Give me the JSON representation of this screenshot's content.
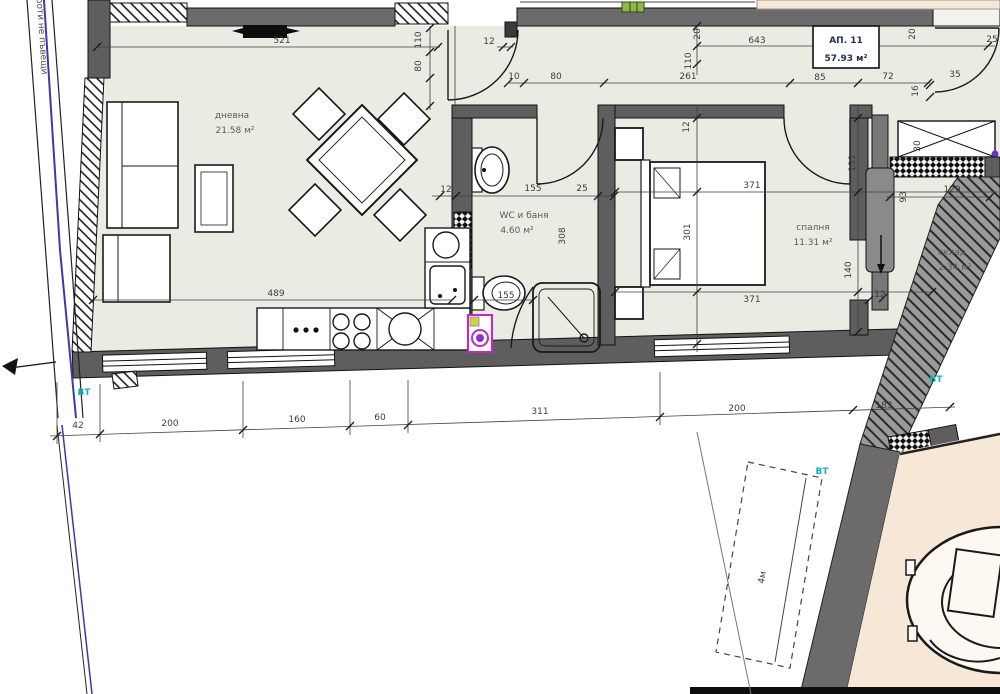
{
  "plan": {
    "apartment": {
      "label": "АП. 11",
      "area": "57.93 м²"
    },
    "rooms": [
      {
        "name": "дневна",
        "area": "21.58 м²"
      },
      {
        "name": "WC и баня",
        "area": "4.60 м²"
      },
      {
        "name": "спалня",
        "area": "11.31 м²"
      },
      {
        "name": "склад",
        "area": "2.34 м²"
      }
    ],
    "boundary_note": "до коелботи не пъвещи",
    "vt_marker": "ВТ",
    "offset_label": "4м",
    "dimension_chains": {
      "top_living": [
        "521"
      ],
      "entry": [
        "110",
        "80",
        "12",
        "10",
        "80",
        "261"
      ],
      "corridor": [
        "643",
        "20",
        "110",
        "85",
        "72",
        "16",
        "20",
        "25",
        "35"
      ],
      "bathroom": [
        "12",
        "155",
        "25",
        "308",
        "155"
      ],
      "bedroom": [
        "371",
        "301",
        "371",
        "12",
        "131",
        "140"
      ],
      "storage": [
        "129",
        "93",
        "30",
        "12"
      ],
      "kitchen": [
        "489"
      ],
      "bottom": [
        "42",
        "200",
        "160",
        "60",
        "311",
        "200",
        "183"
      ]
    },
    "colors": {
      "wall": "#5e5e5e",
      "corridor_band": "#6b6b6b",
      "interior": "#eaece4",
      "neighbor_fill": "#f6e7d7",
      "accent_teal": "#17b1b1",
      "boundary_blue": "#3a3aa8",
      "washer_magenta": "#cc22cc",
      "dot_purple": "#6633cc",
      "marker_green": "#8db84a"
    }
  },
  "texts": [
    {
      "n": "dim-521",
      "t": "521",
      "x": 282,
      "y": 43
    },
    {
      "n": "dim-110-entry",
      "t": "110",
      "x": 421,
      "y": 40,
      "r": -90,
      "s": 8
    },
    {
      "n": "dim-80-entry",
      "t": "80",
      "x": 421,
      "y": 66,
      "r": -90,
      "s": 8
    },
    {
      "n": "dim-12-entry",
      "t": "12",
      "x": 489,
      "y": 44,
      "s": 8
    },
    {
      "n": "dim-10",
      "t": "10",
      "x": 514,
      "y": 79,
      "s": 8
    },
    {
      "n": "dim-80",
      "t": "80",
      "x": 556,
      "y": 79
    },
    {
      "n": "dim-261",
      "t": "261",
      "x": 688,
      "y": 79
    },
    {
      "n": "dim-85",
      "t": "85",
      "x": 820,
      "y": 80,
      "s": 8
    },
    {
      "n": "dim-72",
      "t": "72",
      "x": 888,
      "y": 79,
      "s": 8
    },
    {
      "n": "dim-643",
      "t": "643",
      "x": 757,
      "y": 43
    },
    {
      "n": "dim-20-a",
      "t": "20",
      "x": 700,
      "y": 34,
      "r": -90,
      "s": 8
    },
    {
      "n": "dim-110-b",
      "t": "110",
      "x": 691,
      "y": 61,
      "r": -90,
      "s": 8
    },
    {
      "n": "dim-20-b",
      "t": "20",
      "x": 915,
      "y": 34,
      "r": -90,
      "s": 8
    },
    {
      "n": "dim-25",
      "t": "25",
      "x": 992,
      "y": 42,
      "s": 8
    },
    {
      "n": "dim-35",
      "t": "35",
      "x": 955,
      "y": 77,
      "s": 8
    },
    {
      "n": "dim-16",
      "t": "16",
      "x": 918,
      "y": 91,
      "r": -90,
      "s": 8
    },
    {
      "n": "dim-30",
      "t": "30",
      "x": 920,
      "y": 146,
      "r": -90,
      "s": 8
    },
    {
      "n": "dim-129",
      "t": "129",
      "x": 952,
      "y": 192,
      "s": 8
    },
    {
      "n": "dim-93",
      "t": "93",
      "x": 906,
      "y": 197,
      "r": -90,
      "s": 8
    },
    {
      "n": "room-storage-name",
      "t": "склад",
      "x": 952,
      "y": 255,
      "c": "room"
    },
    {
      "n": "room-storage-area",
      "t": "2.34 м²",
      "x": 955,
      "y": 270,
      "c": "room"
    },
    {
      "n": "dim-12-storage",
      "t": "12",
      "x": 880,
      "y": 297,
      "s": 8
    },
    {
      "n": "room-bedroom-name",
      "t": "спалня",
      "x": 813,
      "y": 230,
      "c": "room"
    },
    {
      "n": "room-bedroom-area",
      "t": "11.31 м²",
      "x": 813,
      "y": 245,
      "c": "room"
    },
    {
      "n": "dim-371-top",
      "t": "371",
      "x": 752,
      "y": 188
    },
    {
      "n": "dim-371-bottom",
      "t": "371",
      "x": 752,
      "y": 302
    },
    {
      "n": "dim-301",
      "t": "301",
      "x": 690,
      "y": 232,
      "r": -90
    },
    {
      "n": "dim-12-bedroom",
      "t": "12",
      "x": 689,
      "y": 127,
      "r": -90,
      "s": 8
    },
    {
      "n": "dim-131",
      "t": "131",
      "x": 855,
      "y": 163,
      "r": -90,
      "s": 8
    },
    {
      "n": "dim-140",
      "t": "140",
      "x": 851,
      "y": 270,
      "r": -90,
      "s": 8
    },
    {
      "n": "room-bath-name",
      "t": "WC и баня",
      "x": 524,
      "y": 218,
      "c": "room"
    },
    {
      "n": "room-bath-area",
      "t": "4.60 м²",
      "x": 517,
      "y": 233,
      "c": "room"
    },
    {
      "n": "dim-12-bath",
      "t": "12",
      "x": 446,
      "y": 192,
      "s": 8
    },
    {
      "n": "dim-155-top",
      "t": "155",
      "x": 533,
      "y": 191
    },
    {
      "n": "dim-25-bath",
      "t": "25",
      "x": 582,
      "y": 191,
      "s": 8
    },
    {
      "n": "dim-308",
      "t": "308",
      "x": 565,
      "y": 236,
      "r": -90,
      "s": 8
    },
    {
      "n": "dim-155-bottom",
      "t": "155",
      "x": 506,
      "y": 298,
      "s": 8
    },
    {
      "n": "room-living-name",
      "t": "дневна",
      "x": 232,
      "y": 118,
      "c": "room"
    },
    {
      "n": "room-living-area",
      "t": "21.58 м²",
      "x": 235,
      "y": 133,
      "c": "room"
    },
    {
      "n": "dim-489",
      "t": "489",
      "x": 276,
      "y": 296,
      "s": 8
    },
    {
      "n": "dim-42",
      "t": "42",
      "x": 78,
      "y": 428,
      "s": 8
    },
    {
      "n": "dim-200-a",
      "t": "200",
      "x": 170,
      "y": 426
    },
    {
      "n": "dim-160",
      "t": "160",
      "x": 297,
      "y": 422
    },
    {
      "n": "dim-60",
      "t": "60",
      "x": 380,
      "y": 420,
      "s": 8
    },
    {
      "n": "dim-311",
      "t": "311",
      "x": 540,
      "y": 414
    },
    {
      "n": "dim-200-b",
      "t": "200",
      "x": 737,
      "y": 411
    },
    {
      "n": "dim-183",
      "t": "183",
      "x": 884,
      "y": 408
    },
    {
      "n": "offset-4m",
      "t": "4м",
      "x": 765,
      "y": 578,
      "r": -80,
      "s": 8
    },
    {
      "n": "vt-marker-left",
      "t": "ВТ",
      "x": 84,
      "y": 395,
      "c": "vt",
      "s": 9
    },
    {
      "n": "vt-marker-right",
      "t": "ВТ",
      "x": 936,
      "y": 382,
      "c": "vt",
      "s": 9
    },
    {
      "n": "vt-marker-terrace",
      "t": "ВТ",
      "x": 822,
      "y": 474,
      "c": "vt",
      "s": 8
    },
    {
      "n": "apartment-number",
      "t": "АП. 11",
      "x": 846,
      "y": 43,
      "c": "ap",
      "s": 10
    },
    {
      "n": "apartment-area",
      "t": "57.93 м²",
      "x": 846,
      "y": 61,
      "c": "ap",
      "s": 10
    },
    {
      "n": "boundary-note",
      "t": "до коелботи не пъвещи",
      "x": 38,
      "y": 18,
      "r": 86,
      "c": "note",
      "s": 8
    }
  ]
}
